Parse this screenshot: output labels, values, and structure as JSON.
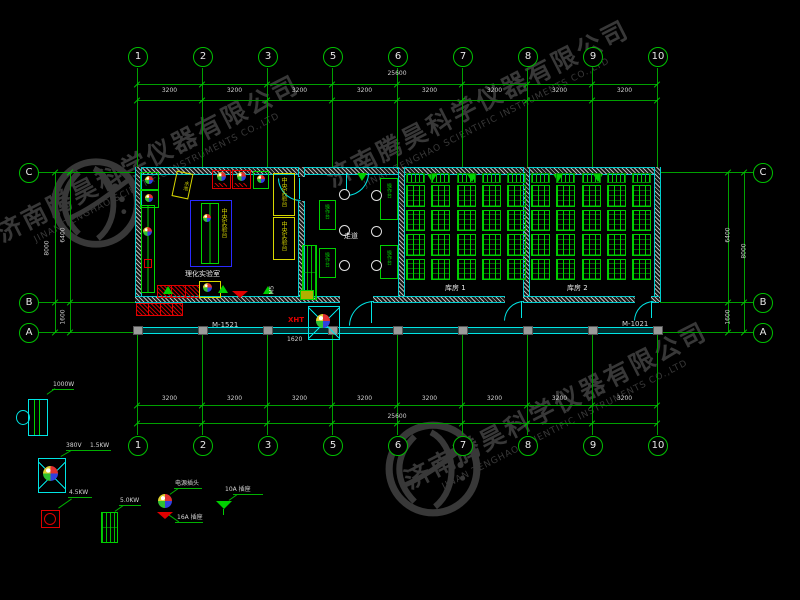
{
  "watermark": {
    "company_cn": "济南腾昊科学仪器有限公司",
    "company_en": "JINAN TENGHAO SCIENTIFIC INSTRUMENTS CO.,LTD"
  },
  "grid": {
    "top_axes": [
      "1",
      "2",
      "3",
      "5",
      "6",
      "7",
      "8",
      "9",
      "10"
    ],
    "bottom_axes": [
      "1",
      "2",
      "3",
      "5",
      "6",
      "7",
      "8",
      "9",
      "10"
    ],
    "side_axes": [
      "C",
      "B",
      "A"
    ],
    "total_dim": "25600",
    "bay_dim": "3200",
    "left_dims": {
      "outer": "8000",
      "upper": "6400",
      "lower": "1600"
    },
    "right_dims": {
      "outer": "8000",
      "upper": "6400",
      "lower": "1600"
    }
  },
  "plan": {
    "room_left_label": "理化实验室",
    "room_store1_label": "库房 1",
    "room_store2_label": "库房 2",
    "corridor_label": "走道",
    "bench_label": "中央实验台",
    "sink_label": "水池",
    "cabinet_label": "操作台",
    "door_left": "M-1521",
    "door_right": "M-1021",
    "door_tag": "M5",
    "fan_tag": "XHT",
    "dim_small": "1620",
    "cages": {
      "rooms": 2,
      "columns": 5,
      "blocks": 4
    }
  },
  "legend": {
    "oven_power": "1000W",
    "fan_voltage": "380V",
    "fan_power": "1.5KW",
    "stove_power": "4.5KW",
    "heater_power": "5.0KW",
    "plug_label": "电源插头",
    "socket16_label": "16A 插座",
    "socket10_label": "10A 插座"
  }
}
